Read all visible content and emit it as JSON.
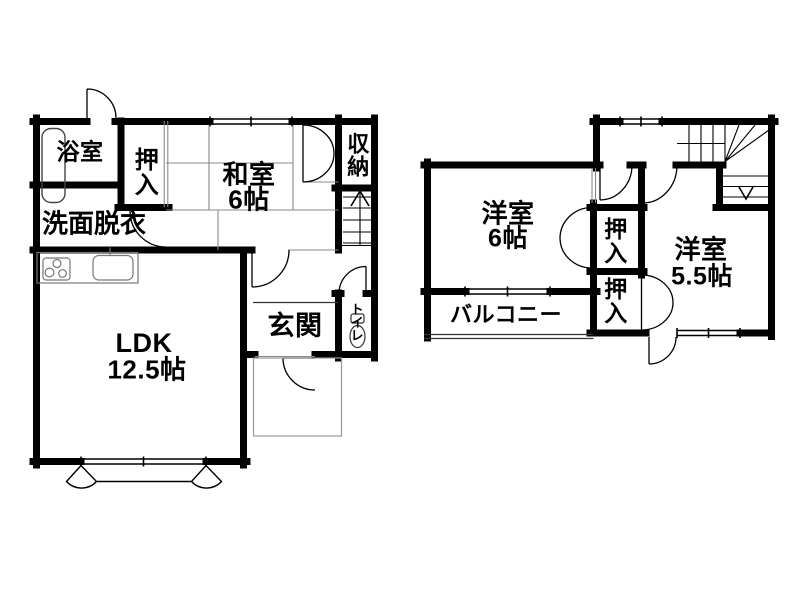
{
  "plan": {
    "type": "floor-plan",
    "floor1": {
      "bath": "浴室",
      "closet": "押入",
      "japanese_room": "和室",
      "japanese_room_size": "6帖",
      "storage": "収納",
      "washroom": "洗面脱衣",
      "living": "LDK",
      "living_size": "12.5帖",
      "entrance": "玄関",
      "toilet": "トイレ"
    },
    "floor2": {
      "western_room_a": "洋室",
      "western_room_a_size": "6帖",
      "closet_upper": "押入",
      "closet_lower": "押入",
      "western_room_b": "洋室",
      "western_room_b_size": "5.5帖",
      "balcony": "バルコニー"
    },
    "colors": {
      "wall": "#000000",
      "background": "#ffffff",
      "thin_line": "#888888"
    }
  }
}
